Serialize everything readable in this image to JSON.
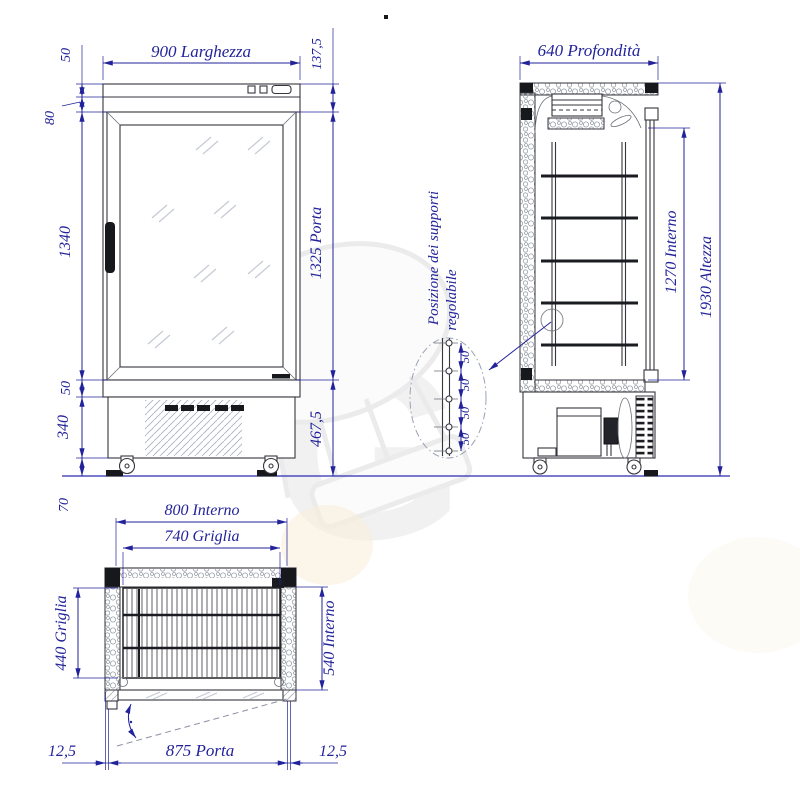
{
  "drawing": {
    "colors": {
      "dimension": "#22229b",
      "object_line": "#35363e",
      "ground_line": "#2a2ab0"
    },
    "front_view": {
      "dims": {
        "top_band": "50",
        "width": "900 Larghezza",
        "head_height": "137,5",
        "mid_band": "80",
        "body_height": "1340",
        "door_height": "1325 Porta",
        "plinth": "50",
        "machine_height": "340",
        "lower_height": "467,5",
        "castor_height": "70"
      }
    },
    "side_view": {
      "dims": {
        "depth": "640 Profondità",
        "internal_height": "1270 Interno",
        "total_height": "1930 Altezza"
      }
    },
    "detail": {
      "label_line1": "Posizione dei supporti",
      "label_line2": "regolabile",
      "spacing": [
        "50",
        "50",
        "50",
        "50"
      ]
    },
    "plan_view": {
      "dims": {
        "internal_width": "800 Interno",
        "grid_width": "740 Griglia",
        "grid_depth": "440 Griglia",
        "internal_depth": "540 Interno",
        "door_inset_left": "12,5",
        "door_width": "875 Porta",
        "door_inset_right": "12,5"
      }
    }
  }
}
